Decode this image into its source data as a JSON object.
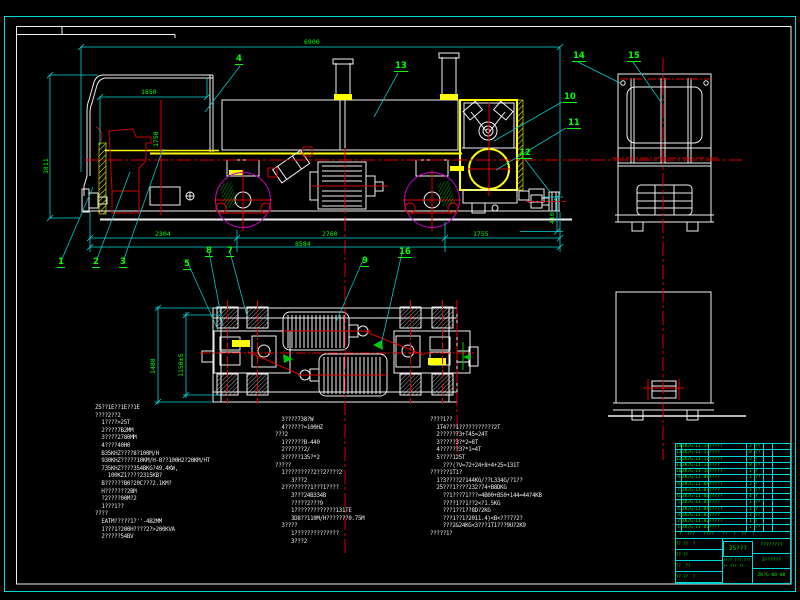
{
  "colors": {
    "background": "#000000",
    "linework": "#f0f0f0",
    "dimension_lines": "#00d8d8",
    "dimension_text": "#00ff00",
    "centerlines": "#e00000",
    "highlight": "#ffff00",
    "wheel_circle": "#cc00cc"
  },
  "dims": {
    "overall_length": "6900",
    "cab_width": "1850",
    "cab_height": "1750",
    "overall_height": "1811",
    "span_left": "2304",
    "span_mid": "2760",
    "span_right": "1755",
    "frame_length": "8584",
    "coupler_height": "410",
    "plan_outer_width": "1488",
    "plan_gauge": "1150±5"
  },
  "callouts": [
    "1",
    "2",
    "3",
    "4",
    "5",
    "8",
    "7",
    "9",
    "16",
    "13",
    "10",
    "11",
    "12",
    "14",
    "15"
  ],
  "notes": {
    "col1": [
      "Z5??1E??1E??1E",
      "????2??2",
      "  1????>25T",
      "  2????7B2MM",
      "  3????2780MM",
      "  4????40H0",
      "  B35KHZ????8?100M/H",
      "  930KHZ?????10KM/H-8??100H2?20KM/HT",
      "  735KHZ????354BKG?49.4KW,",
      "    100KZ1????2315KB?",
      "  B??????B0?20C???2.1KM?",
      "  H???????2BM",
      "  ?2????00M?2",
      "  1???1??",
      "????",
      "  EATM?????1?''-4B2MM",
      "  1???1?200H????2?>200KVA",
      "  2?????54BV"
    ],
    "col2": [
      "  3????738?W",
      "  4??????=100HZ",
      "???2",
      "  1??????B-440",
      "  2??????2/",
      "  3?????135?*2",
      "?????",
      "  1?????????2??2????2",
      "     3???2",
      "  2????????1???1????",
      "     3???24B334B",
      "     ?????2???9",
      "     1?????????????131TE",
      "     3D8??110M/H???????0.75M",
      "  3????",
      "     1??????????????",
      "     3???2"
    ],
    "col3": [
      "????1??",
      "  1T4???1???????????2T",
      "  2?????73+T45=24T",
      "  3?????3?*2=8T",
      "  4??????3?*1=4T",
      "  5????125T",
      "    ???(?V=72+24+8+4+25=131T",
      "??????1T1?",
      "  1?3????2?144KG/??L334G/?1??",
      "  25???1????232?74+B8DKG",
      "    ??1???71???=4B00+B50+144=44?4KB",
      "    ????1??1??2<?1.5KG",
      "    ???1??1??8D?2KG",
      "    ???1??1?2011.4)<B<???7?2?",
      "    ???2&24KG<3???1T1???9U?2K9",
      "?????1?"
    ]
  },
  "title_block": {
    "rows": [
      {
        "n": "14",
        "code": "ZK7G-II-14",
        "name": "?????",
        "qty": "2",
        "m": "??"
      },
      {
        "n": "13",
        "code": "ZK7G-II-13",
        "name": "????",
        "qty": "8",
        "m": "??"
      },
      {
        "n": "12",
        "code": "ZK7G-II-12",
        "name": "?????",
        "qty": "2",
        "m": "?"
      },
      {
        "n": "11",
        "code": "ZK7G-II-11",
        "name": "????",
        "qty": "8",
        "m": "??"
      },
      {
        "n": "10",
        "code": "ZK7G-II-10",
        "name": "?????",
        "qty": "1",
        "m": "?"
      },
      {
        "n": "9",
        "code": "ZK7G-II-09",
        "name": "????",
        "qty": "1",
        "m": "??"
      },
      {
        "n": "8",
        "code": "ZK7G-II-08",
        "name": "?????",
        "qty": "2",
        "m": "?"
      },
      {
        "n": "7",
        "code": "ZK7G-II-07",
        "name": "????",
        "qty": "1",
        "m": "??"
      },
      {
        "n": "6",
        "code": "ZK7G-II-06",
        "name": "?????",
        "qty": "4",
        "m": "?"
      },
      {
        "n": "5",
        "code": "ZK7G-II-05",
        "name": "????",
        "qty": "1",
        "m": "??"
      },
      {
        "n": "4",
        "code": "ZK7G-II-04",
        "name": "?????",
        "qty": "1",
        "m": "?"
      },
      {
        "n": "3",
        "code": "ZK7G-II-03",
        "name": "????",
        "qty": "2",
        "m": "??"
      },
      {
        "n": "2",
        "code": "ZK7G-II-02",
        "name": "?????",
        "qty": "1",
        "m": "?"
      },
      {
        "n": "1",
        "code": "ZK7G-II-01",
        "name": "????",
        "qty": "1",
        "m": "??"
      }
    ],
    "header_text": " ?  ???   ????   ??  ?  ??  ?",
    "sig": [
      "?? ??  ?",
      "?? ??",
      "??  ??",
      "?? ??  ?"
    ],
    "title": "25???",
    "subtitle": "???? ??? ???",
    "subnums": "?? ??? ??",
    "cellA": "????????",
    "cellB": "3??????",
    "cellC": "ZK?G-00-00"
  }
}
